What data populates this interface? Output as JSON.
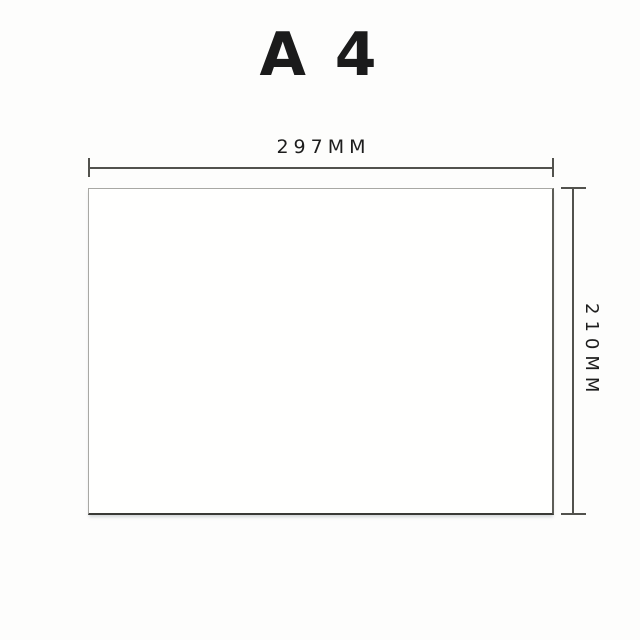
{
  "diagram": {
    "title": "A 4",
    "paper": {
      "width_label": "297MM",
      "height_label": "210MM"
    },
    "colors": {
      "background": "#fdfdfc",
      "text": "#1c1c1c",
      "dimension_line": "#52524d",
      "paper_fill": "#fffffe",
      "paper_border_light": "#a8a8a4",
      "paper_border_dark": "#3a3a36"
    }
  }
}
